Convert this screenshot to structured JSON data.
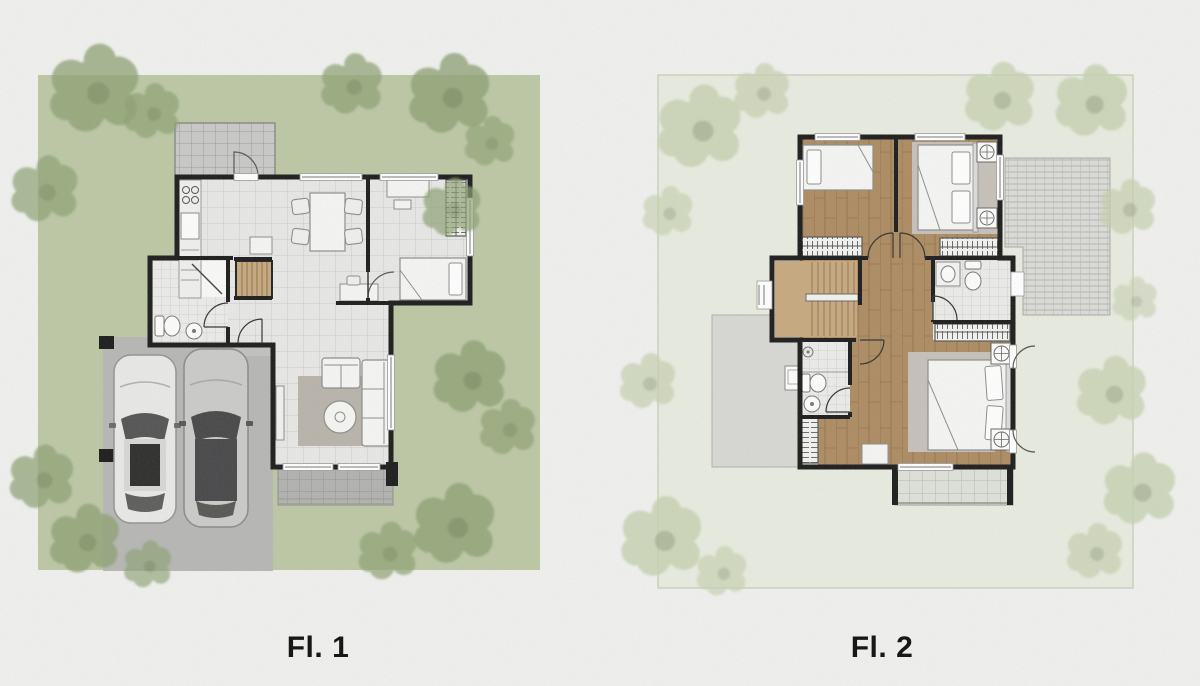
{
  "plans": [
    {
      "id": "fl1",
      "label": "Fl. 1"
    },
    {
      "id": "fl2",
      "label": "Fl. 2"
    }
  ],
  "icons": {
    "trees": "tree-icon",
    "cars": "car-icon",
    "fixtures": [
      "stove-icon",
      "sink-icon",
      "toilet-icon",
      "shower-icon",
      "lamp-icon"
    ]
  },
  "colors": {
    "paper": "#f1f1ef",
    "lawn": "#bdc8a5",
    "tree_left": "#8ea172",
    "tree_right": "#c6d1b0",
    "lot2": "#e9ece0",
    "lot2_border": "#b9c3a6",
    "wall": "#1c1c1c",
    "tile": "#e8e8e6",
    "bath_tile": "#ececea",
    "wood": "#ad8c62",
    "stairs_wood": "#c7a97e",
    "concrete": "#b7b7b5",
    "service_tile": "#c9c9c7",
    "terrace_tile": "#b2b2b0",
    "roof_tile": "#dcdcd9",
    "roof_slab": "#d8d8d5",
    "balcony": "#dfe2da",
    "rug_living": "#b9b4ab",
    "rug_bedroom": "#c6c2ba",
    "car_silver": "#e9e9e7",
    "car_gray": "#cbcbc9",
    "car_glass": "#3a3a3a",
    "furniture": "#f6f6f4",
    "outline": "#8d8d8b",
    "label": "#171717"
  }
}
